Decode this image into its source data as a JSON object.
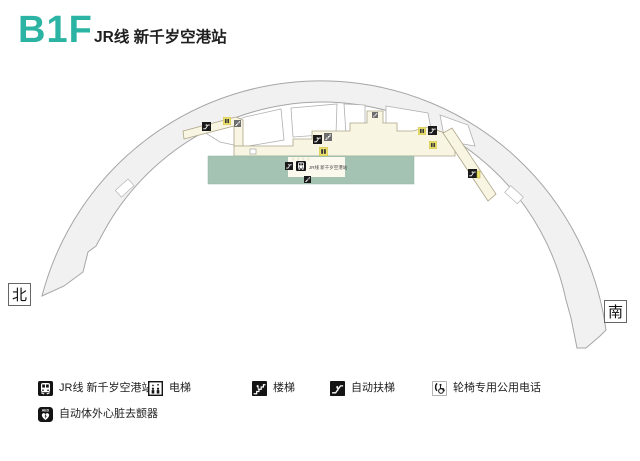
{
  "header": {
    "floor": "B1F",
    "title": "JR线 新千岁空港站"
  },
  "map": {
    "north": "北",
    "south": "南",
    "station_label": "JR线 新千岁空港站",
    "colors": {
      "accent_teal": "#2BB4A3",
      "platform_green": "#A5C3B2",
      "corridor_cream": "#F8F5E2",
      "terminal_arc_gray": "#F1F1F1",
      "elevator_yellow": "#EDE36A"
    }
  },
  "legend": {
    "items": [
      {
        "icon": "jr-train-icon",
        "label": "JR线 新千岁空港站"
      },
      {
        "icon": "elevator-icon",
        "label": "电梯"
      },
      {
        "icon": "stairs-icon",
        "label": "楼梯"
      },
      {
        "icon": "escalator-icon",
        "label": "自动扶梯"
      },
      {
        "icon": "wheelchair-phone-icon",
        "label": "轮椅专用公用电话"
      },
      {
        "icon": "aed-icon",
        "label": "自动体外心脏去颤器"
      }
    ]
  }
}
